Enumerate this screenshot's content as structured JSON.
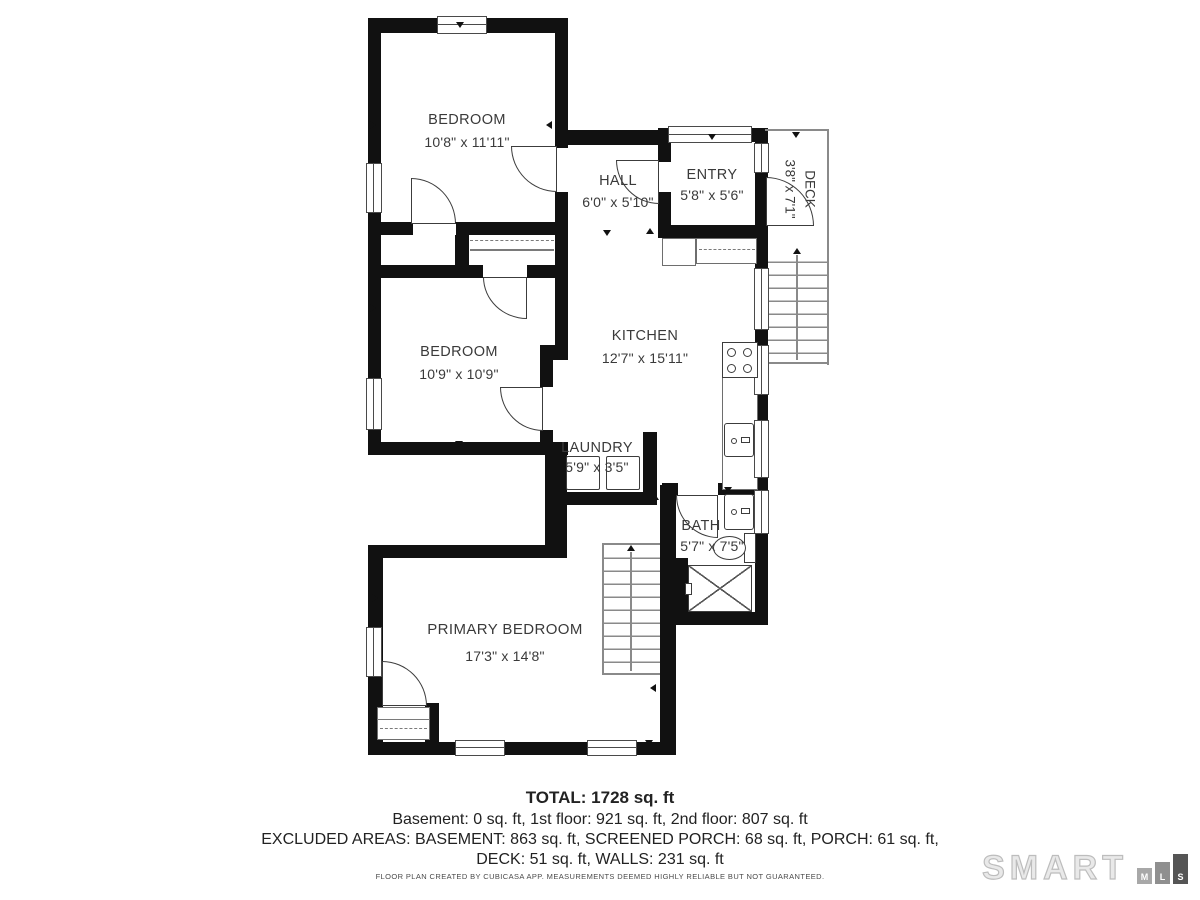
{
  "plan": {
    "rooms": [
      {
        "name": "BEDROOM",
        "dims": "10'8\" x 11'11\""
      },
      {
        "name": "HALL",
        "dims": "6'0\" x 5'10\""
      },
      {
        "name": "ENTRY",
        "dims": "5'8\" x 5'6\""
      },
      {
        "name": "DECK",
        "dims": "3'8\" x 7'1\""
      },
      {
        "name": "BEDROOM",
        "dims": "10'9\" x 10'9\""
      },
      {
        "name": "KITCHEN",
        "dims": "12'7\" x 15'11\""
      },
      {
        "name": "LAUNDRY",
        "dims": "5'9\" x 3'5\""
      },
      {
        "name": "BATH",
        "dims": "5'7\" x 7'5\""
      },
      {
        "name": "PRIMARY BEDROOM",
        "dims": "17'3\" x 14'8\""
      }
    ],
    "colors": {
      "wall": "#111111",
      "line": "#3c3c3c",
      "text": "#3a3a3a"
    }
  },
  "summary": {
    "total": "TOTAL: 1728 sq. ft",
    "floors": "Basement: 0 sq. ft, 1st floor: 921 sq. ft, 2nd floor: 807 sq. ft",
    "excluded1": "EXCLUDED AREAS: BASEMENT: 863 sq. ft, SCREENED PORCH: 68 sq. ft, PORCH: 61 sq. ft,",
    "excluded2": "DECK: 51 sq. ft, WALLS: 231 sq. ft",
    "disclaimer": "FLOOR PLAN CREATED BY CUBICASA APP. MEASUREMENTS DEEMED HIGHLY RELIABLE BUT NOT GUARANTEED."
  },
  "logo": {
    "word": "SMART",
    "m": "M",
    "l": "L",
    "s": "S"
  }
}
